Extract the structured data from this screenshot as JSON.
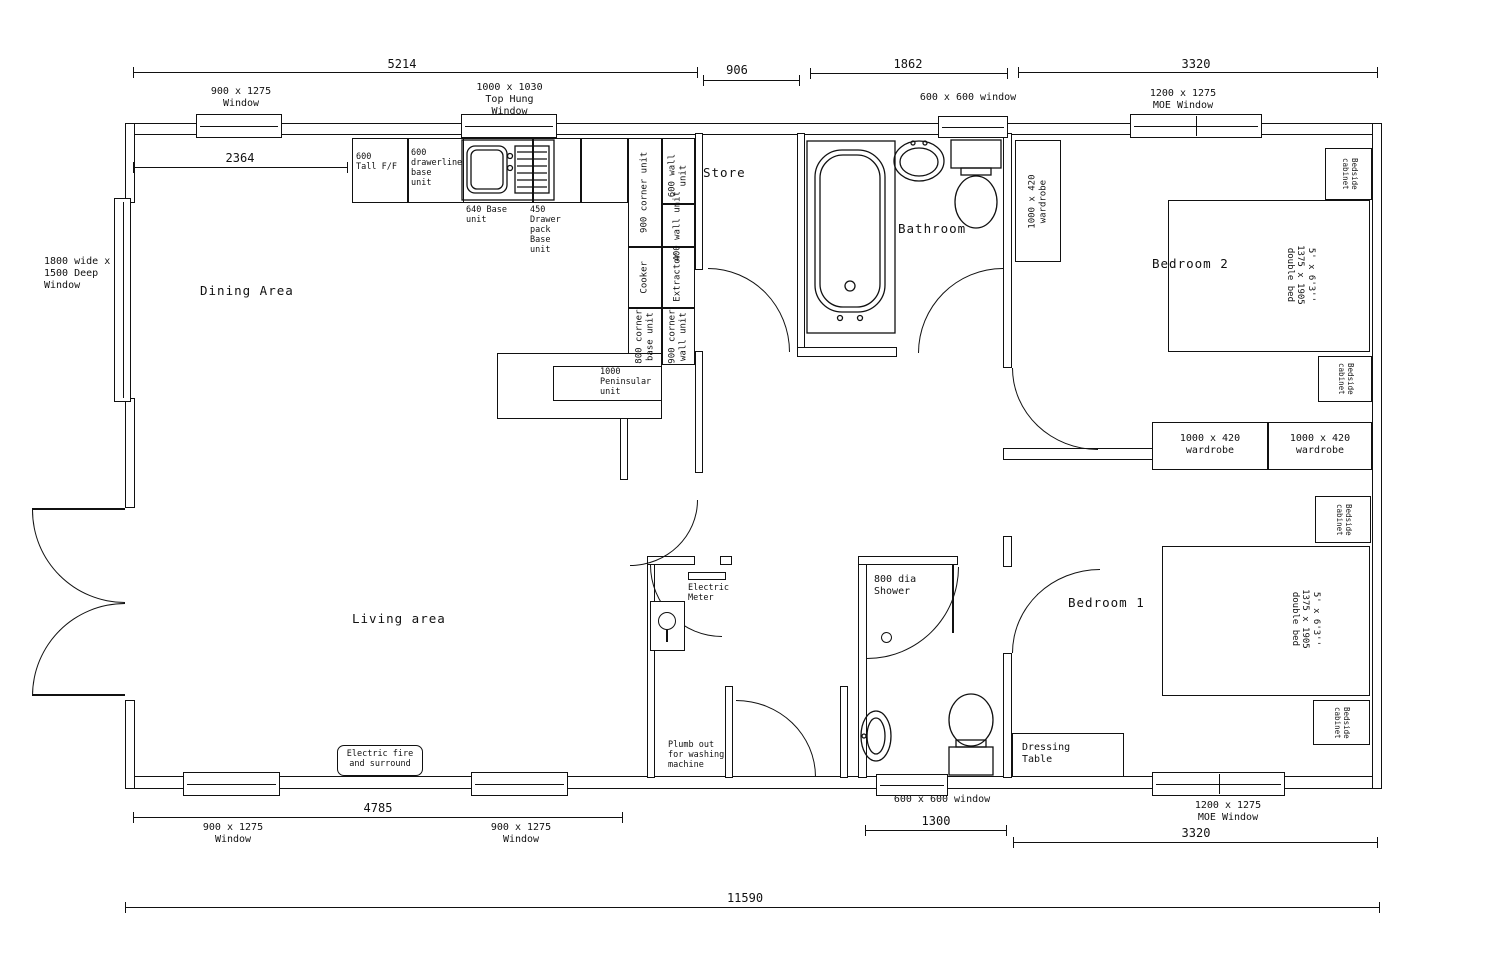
{
  "rooms": {
    "dining": "Dining Area",
    "living": "Living area",
    "store": "Store",
    "bathroom": "Bathroom",
    "bedroom2": "Bedroom 2",
    "bedroom1": "Bedroom 1"
  },
  "dims": {
    "d5214": "5214",
    "d906": "906",
    "d1862": "1862",
    "d3320_top": "3320",
    "d2364": "2364",
    "d4785": "4785",
    "d1300": "1300",
    "d3320_bottom": "3320",
    "d11590": "11590"
  },
  "windows": {
    "win_tl": "900 x 1275\nWindow",
    "win_tophung": "1000 x 1030\nTop Hung\nWindow",
    "win_bath": "600 x 600 window",
    "win_moe_top": "1200 x 1275\nMOE Window",
    "win_left": "1800 wide x\n1500 Deep\nWindow",
    "win_bl1": "900 x 1275\nWindow",
    "win_bl2": "900 x 1275\nWindow",
    "win_shower": "600 x 600 window",
    "win_moe_bottom": "1200 x 1275\nMOE Window"
  },
  "kitchen": {
    "tall_ff": "600\nTall F/F",
    "drawerline": "600\ndrawerline\nbase\nunit",
    "base_640": "640 Base\nunit",
    "drawer_450": "450\nDrawer\npack\nBase\nunit",
    "corner_900": "900 corner unit",
    "wall_600": "600 wall unit",
    "wall_400": "400 wall unit",
    "cooker": "Cooker",
    "extractor": "Extractor",
    "corner_base_800": "800 corner\nbase unit",
    "corner_wall_900": "900 corner\nwall unit",
    "peninsular": "1000\nPeninsular\nunit"
  },
  "furniture": {
    "wardrobe": "1000 x 420\nwardrobe",
    "bed": "5' x 6'3''\n1375 x 1905\ndouble bed",
    "bedside": "Bedside\ncabinet",
    "dressing_table": "Dressing\nTable",
    "electric_fire": "Electric fire\nand surround",
    "electric_meter": "Electric\nMeter",
    "plumb_out": "Plumb out\nfor washing\nmachine",
    "shower": "800 dia\nShower"
  }
}
